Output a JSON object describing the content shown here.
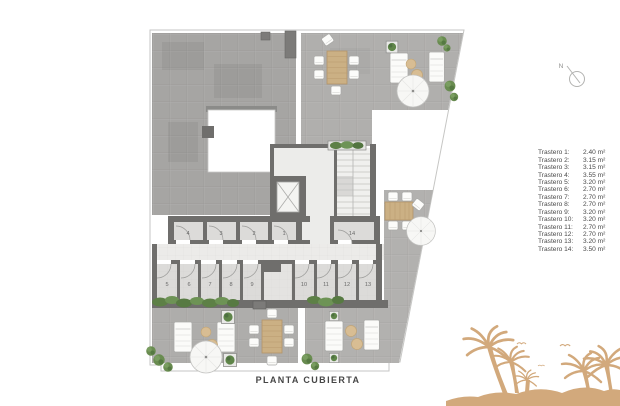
{
  "title": "PLANTA CUBIERTA",
  "north_label": "N",
  "legend": {
    "items": [
      {
        "label": "Trastero 1:",
        "area": "2.40 m²"
      },
      {
        "label": "Trastero 2:",
        "area": "3.15 m²"
      },
      {
        "label": "Trastero 3:",
        "area": "3.15 m²"
      },
      {
        "label": "Trastero 4:",
        "area": "3.55 m²"
      },
      {
        "label": "Trastero 5:",
        "area": "3.20 m²"
      },
      {
        "label": "Trastero 6:",
        "area": "2.70 m²"
      },
      {
        "label": "Trastero 7:",
        "area": "2.70 m²"
      },
      {
        "label": "Trastero 8:",
        "area": "2.70 m²"
      },
      {
        "label": "Trastero 9:",
        "area": "3.20 m²"
      },
      {
        "label": "Trastero 10:",
        "area": "3.20 m²"
      },
      {
        "label": "Trastero 11:",
        "area": "2.70 m²"
      },
      {
        "label": "Trastero 12:",
        "area": "2.70 m²"
      },
      {
        "label": "Trastero 13:",
        "area": "3.20 m²"
      },
      {
        "label": "Trastero 14:",
        "area": "3.50 m²"
      }
    ]
  },
  "plan": {
    "rooms": [
      "1",
      "2",
      "3",
      "4",
      "5",
      "6",
      "7",
      "8",
      "9",
      "10",
      "11",
      "12",
      "13",
      "14"
    ]
  },
  "colors": {
    "palm": "#d2a97c",
    "wall": "#6f6e6c",
    "hedge": "#5f8549",
    "wood": "#cbb084",
    "terrace": "#aeadab"
  }
}
